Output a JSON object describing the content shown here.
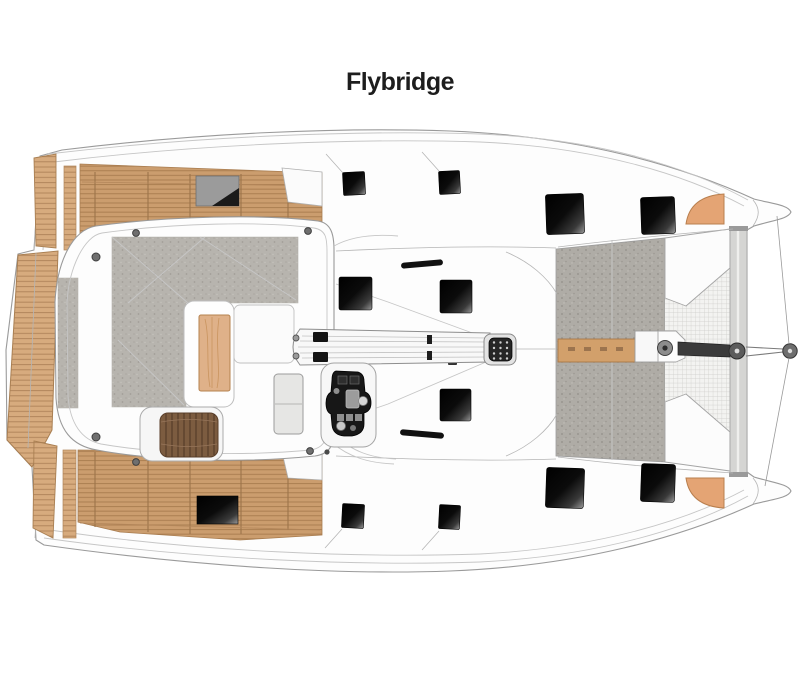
{
  "title": "Flybridge",
  "diagram": {
    "type": "deck-plan",
    "subject": "catamaran flybridge level, top view, bow to the right",
    "parts": [
      "hull-port",
      "hull-starboard",
      "swim-platform",
      "aft-deck-port",
      "aft-deck-starboard",
      "flybridge-lounge",
      "lounge-bench",
      "lounge-table",
      "sunbed",
      "helm-seat",
      "helm-console",
      "boom",
      "mast",
      "coachroof",
      "deck-hatches",
      "handrails",
      "foredeck",
      "anchor-windlass",
      "bowsprit",
      "trampoline-net",
      "forward-crossbeam"
    ]
  },
  "colors": {
    "background": "#ffffff",
    "title_text": "#1d1d1d",
    "teak_deck": "#cb9d6e",
    "teak_lines": "#a87c4f",
    "platform_wood": "#d7ab7e",
    "table_wood": "#dfb189",
    "sunbed_wood": "#7c5c40",
    "carpet_gray": "#b7b4ae",
    "foredeck_gray": "#afaca6",
    "hatch_black": "#0a0a0a",
    "hull_white": "#fdfdfd",
    "outline_gray": "#9a9a9a",
    "net_gray": "#f3f3f1",
    "bow_accent_tan": "#e4a474",
    "console_black": "#171717"
  }
}
